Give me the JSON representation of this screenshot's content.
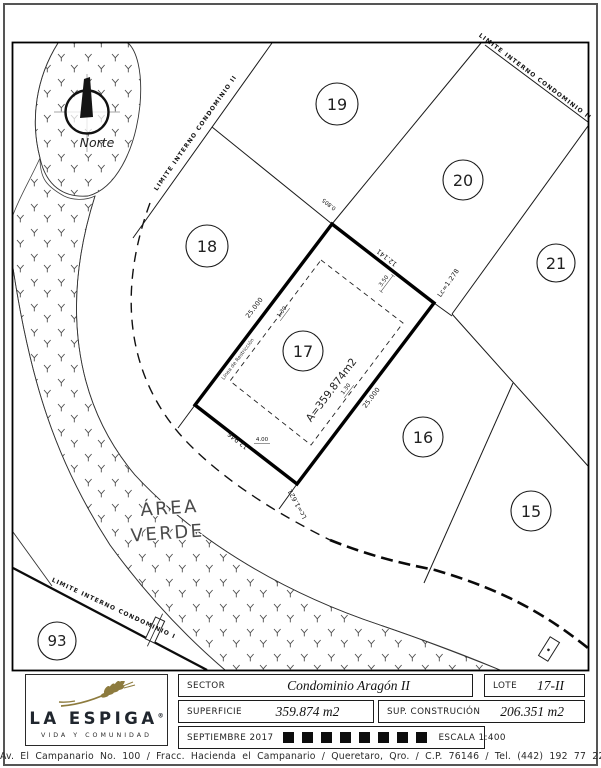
{
  "map": {
    "north_label": "Norte",
    "area_verde_line1": "ÁREA",
    "area_verde_line2": "VERDE",
    "limite_ii_left": "LIMITE INTERNO CONDOMINIO II",
    "limite_ii_right": "LIMITE INTERNO CONDOMINIO II",
    "limite_i": "LIMITE INTERNO CONDOMINIO I",
    "lots": [
      {
        "number": "19"
      },
      {
        "number": "20"
      },
      {
        "number": "21"
      },
      {
        "number": "18"
      },
      {
        "number": "17"
      },
      {
        "number": "16"
      },
      {
        "number": "15"
      },
      {
        "number": "93"
      }
    ],
    "lot17": {
      "area": "A=359.874m2",
      "restriction_line": "Línea de Restricción",
      "side_nw": "25.000",
      "side_ne": "12.141",
      "side_se": "25.000",
      "side_sw": "12.946",
      "corner_e": "Lc=1.278",
      "corner_s": "Lc=1.621",
      "top_offset": "0.805",
      "setback_ne": "3.50",
      "setback_nw": "1.30",
      "setback_se": "1.30",
      "setback_sw": "4.00"
    }
  },
  "title_block": {
    "logo_name": "LA ESPIGA",
    "logo_registered": "®",
    "logo_tagline": "VIDA Y COMUNIDAD",
    "wheat_color": "#8d7b3e",
    "sector_label": "SECTOR",
    "sector_value": "Condominio Aragón II",
    "lote_label": "LOTE",
    "lote_value": "17-II",
    "superficie_label": "SUPERFICIE",
    "superficie_value": "359.874 m2",
    "sup_construccion_label": "SUP. CONSTRUCIÓN",
    "sup_construccion_value": "206.351 m2",
    "fecha_label": "SEPTIEMBRE 2017",
    "escala_label": "ESCALA 1:400"
  },
  "footer": "Av. El Campanario No. 100 / Fracc. Hacienda el Campanario / Queretaro, Qro. / C.P. 76146 / Tel. (442) 192 77 22"
}
